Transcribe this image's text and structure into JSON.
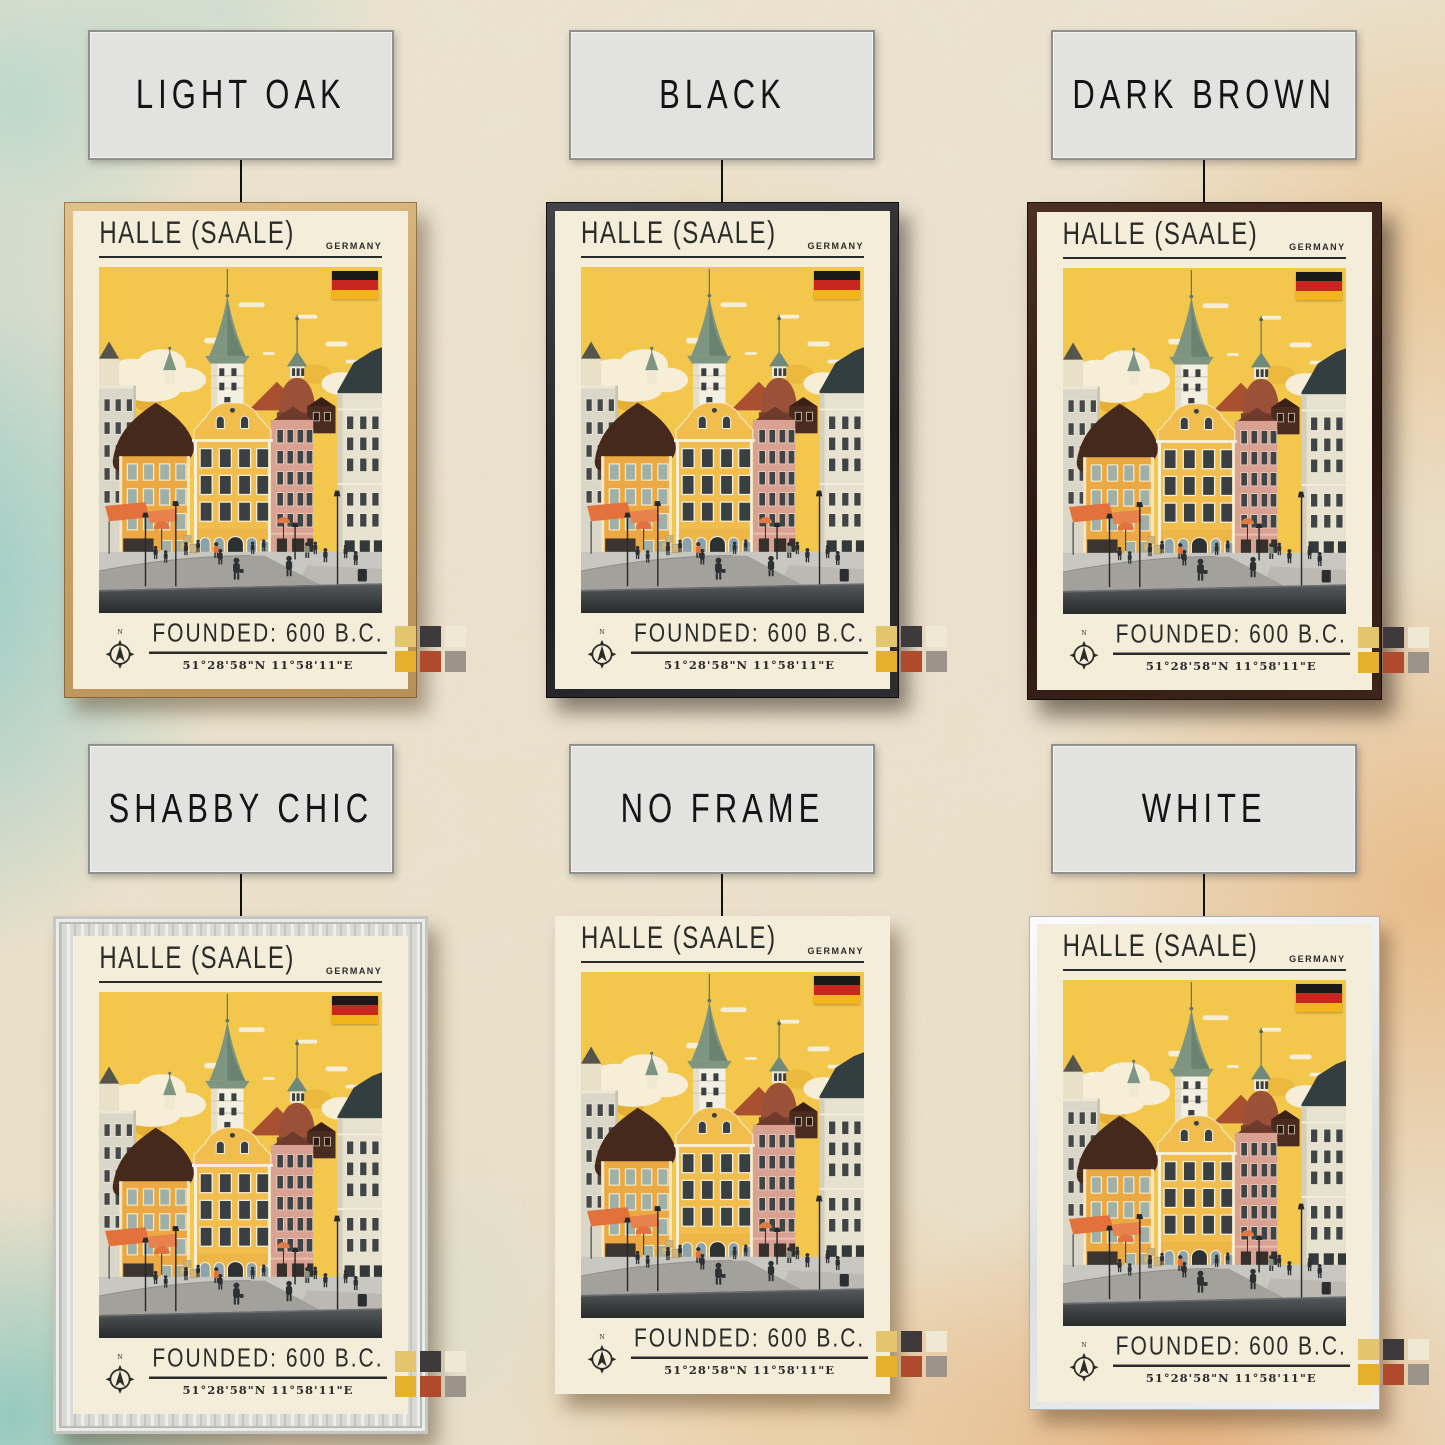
{
  "background": {
    "paper": "#ece5d3",
    "teal_wash": "#54bec6",
    "orange_wash": "#e9913a"
  },
  "poster": {
    "title": "HALLE (SAALE)",
    "country": "GERMANY",
    "founded_label": "FOUNDED: 600 B.C.",
    "coordinates": "51°28'58\"N 11°58'11\"E",
    "compass_north_label": "N",
    "flag_colors": [
      "#191919",
      "#c7271e",
      "#f2b51c"
    ],
    "palette_swatches": [
      "#e2c56e",
      "#3e3a3b",
      "#efe9d4",
      "#e6b02e",
      "#b04a2c",
      "#9c938b"
    ]
  },
  "variants": [
    {
      "label": "LIGHT OAK",
      "frame": "light-oak"
    },
    {
      "label": "BLACK",
      "frame": "black"
    },
    {
      "label": "DARK BROWN",
      "frame": "dark-brown"
    },
    {
      "label": "SHABBY CHIC",
      "frame": "shabby-chic"
    },
    {
      "label": "NO FRAME",
      "frame": "no-frame"
    },
    {
      "label": "WHITE",
      "frame": "white"
    }
  ]
}
